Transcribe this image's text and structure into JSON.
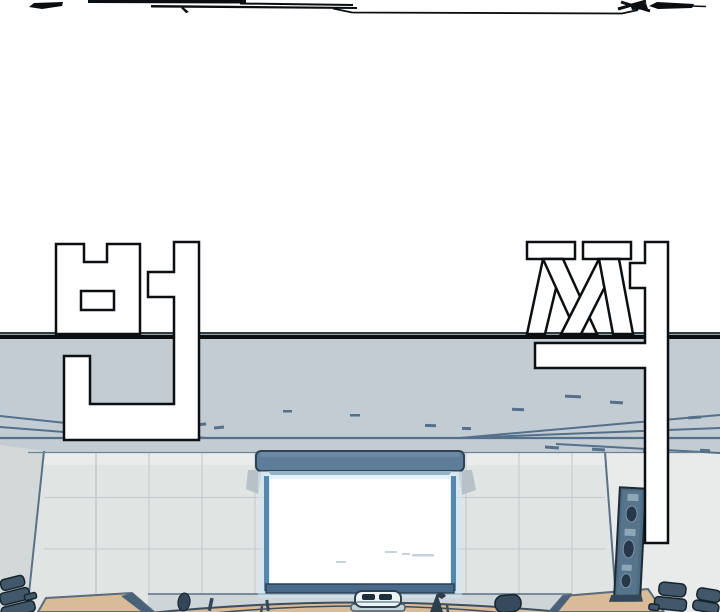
{
  "panel": {
    "type": "webtoon-comic-panel",
    "scene": "lecture hall front wall with glowing projection screen",
    "sfx": {
      "text": "번쩍",
      "chars": [
        "번",
        "쩍"
      ]
    },
    "objects": [
      "ceiling",
      "tiled-wall",
      "projection-screen",
      "screen-housing",
      "speaker-column",
      "left-desk",
      "right-desk",
      "front-curved-desk",
      "office-chairs",
      "mini-projector",
      "audience-heads",
      "motion-scribbles"
    ]
  },
  "colors": {
    "background": "#ffffff",
    "ink": "#0c0f12",
    "panel_gray": "#c3ccd2",
    "wall_tile": "#e0e4e3",
    "wall_tile_light": "#e9ecea",
    "left_wall": "#d3d9d8",
    "right_wall": "#e8ebe9",
    "line_slate": "#54708a",
    "screen_housing": "#5d7d99",
    "screen_frame": "#5588ad",
    "screen_glow": "#cfe7f4",
    "screen_white": "#ffffff",
    "speaker": "#4e6b82",
    "chair": "#41586b",
    "desk_tan": "#d9bb97",
    "desk_trim": "#49627a",
    "sfx_fill": "#ffffff"
  }
}
